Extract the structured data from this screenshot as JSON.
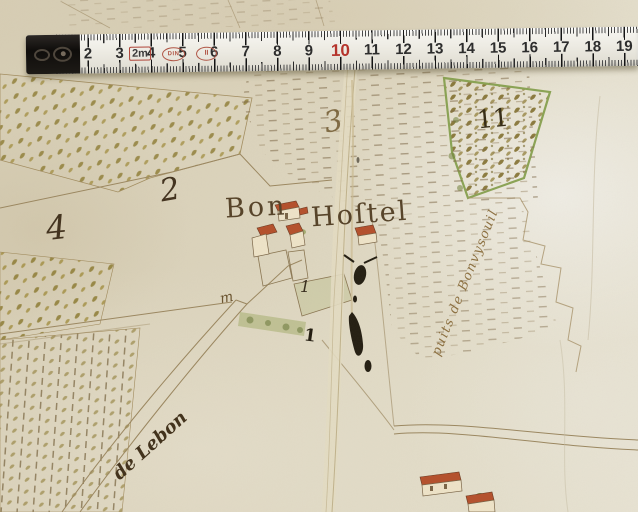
{
  "ruler": {
    "numbers": [
      "2",
      "3",
      "4",
      "5",
      "6",
      "7",
      "8",
      "9",
      "10",
      "11",
      "12",
      "13",
      "14",
      "15",
      "16",
      "17",
      "18",
      "19"
    ],
    "highlighted_number": "10",
    "length_mark": "2m",
    "stamp_left": "DIN",
    "stamp_right": "II"
  },
  "map": {
    "parcel_numbers": {
      "a": "4",
      "b": "2",
      "c": "3",
      "d": "11",
      "e": "1",
      "f": "1"
    },
    "hamlet_name": {
      "word1": "Bon",
      "word2": "Hoſtel"
    },
    "path_label_right": "puits de Bonvysouil",
    "path_label_left": "de Lebon",
    "small_mark": "m"
  },
  "colors": {
    "paper": "#d8d0b9",
    "ink_brown": "#5a4628",
    "ink_black": "#241e12",
    "roof_red": "#b5502f",
    "tuft_olive": "#8d7b33",
    "hedge_green": "#8fa24f",
    "ruler_body": "#edebe4",
    "ruler_red": "#b5342c"
  }
}
